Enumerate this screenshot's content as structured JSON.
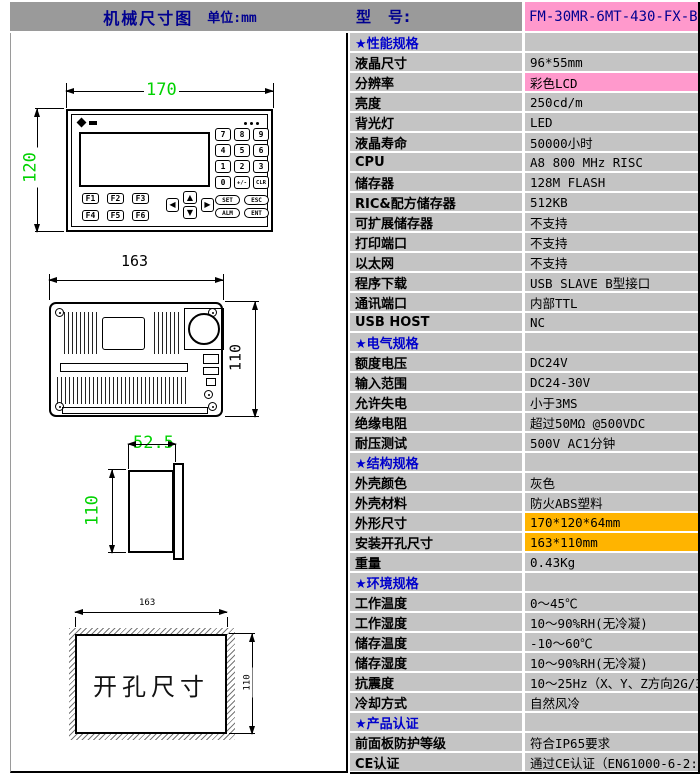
{
  "colors": {
    "header_gray": "#9a9a9a",
    "cell_gray": "#c4c4c4",
    "pink": "#ff99cc",
    "orange": "#ffb400",
    "navy": "#000090",
    "section_blue": "#0000cc",
    "dim_green": "#00d200"
  },
  "header": {
    "left_title": "机械尺寸图",
    "left_unit": "单位:mm",
    "model_label": "型　号:",
    "model_value": "FM-30MR-6MT-430-FX-B"
  },
  "drawings": {
    "front_view": {
      "width_dim": "170",
      "height_dim": "120",
      "numpad_keys": [
        "7",
        "8",
        "9",
        "4",
        "5",
        "6",
        "1",
        "2",
        "3",
        "0",
        "+/-",
        "CLR"
      ],
      "function_keys": [
        "F1",
        "F2",
        "F3",
        "F4",
        "F5",
        "F6"
      ],
      "control_keys": [
        "SET",
        "ESC",
        "ALM",
        "ENT"
      ],
      "arrow_keys": [
        "◀",
        "▲",
        "▼",
        "▶"
      ]
    },
    "back_view": {
      "width_dim": "163",
      "height_dim": "110"
    },
    "side_view": {
      "depth_dim": "52.5",
      "height_dim": "110"
    },
    "cutout_view": {
      "label": "开孔尺寸",
      "width_dim": "163",
      "height_dim": "110"
    }
  },
  "spec_table": {
    "rows": [
      {
        "type": "section",
        "label": "★性能规格",
        "value": ""
      },
      {
        "type": "data",
        "label": "液晶尺寸",
        "value": "96*55mm"
      },
      {
        "type": "data",
        "label": "分辨率",
        "value": "彩色LCD",
        "highlight": "pink"
      },
      {
        "type": "data",
        "label": "亮度",
        "value": "250cd/m"
      },
      {
        "type": "data",
        "label": "背光灯",
        "value": "LED"
      },
      {
        "type": "data",
        "label": "液晶寿命",
        "value": "50000小时"
      },
      {
        "type": "data",
        "label": "CPU",
        "value": "A8 800 MHz RISC"
      },
      {
        "type": "data",
        "label": "储存器",
        "value": "128M FLASH"
      },
      {
        "type": "data",
        "label": "RIC&配方储存器",
        "value": "512KB"
      },
      {
        "type": "data",
        "label": "可扩展储存器",
        "value": "不支持"
      },
      {
        "type": "data",
        "label": "打印端口",
        "value": "不支持"
      },
      {
        "type": "data",
        "label": "以太网",
        "value": "不支持"
      },
      {
        "type": "data",
        "label": "程序下载",
        "value": "USB SLAVE B型接口"
      },
      {
        "type": "data",
        "label": "通讯端口",
        "value": "内部TTL"
      },
      {
        "type": "data",
        "label": "USB HOST",
        "value": "NC"
      },
      {
        "type": "section",
        "label": "★电气规格",
        "value": ""
      },
      {
        "type": "data",
        "label": "额度电压",
        "value": "DC24V"
      },
      {
        "type": "data",
        "label": "输入范围",
        "value": "DC24-30V"
      },
      {
        "type": "data",
        "label": "允许失电",
        "value": "小于3MS"
      },
      {
        "type": "data",
        "label": "绝缘电阻",
        "value": "超过50MΩ @500VDC"
      },
      {
        "type": "data",
        "label": "耐压测试",
        "value": "500V AC1分钟"
      },
      {
        "type": "section",
        "label": "★结构规格",
        "value": ""
      },
      {
        "type": "data",
        "label": "外壳颜色",
        "value": "灰色"
      },
      {
        "type": "data",
        "label": "外壳材料",
        "value": "防火ABS塑料"
      },
      {
        "type": "data",
        "label": "外形尺寸",
        "value": "170*120*64mm",
        "highlight": "orange"
      },
      {
        "type": "data",
        "label": "安装开孔尺寸",
        "value": "163*110mm",
        "highlight": "orange"
      },
      {
        "type": "data",
        "label": "重量",
        "value": "0.43Kg"
      },
      {
        "type": "section",
        "label": "★环境规格",
        "value": ""
      },
      {
        "type": "data",
        "label": "工作温度",
        "value": "0～45℃"
      },
      {
        "type": "data",
        "label": "工作湿度",
        "value": "10～90%RH(无冷凝)"
      },
      {
        "type": "data",
        "label": "储存温度",
        "value": "-10～60℃"
      },
      {
        "type": "data",
        "label": "储存湿度",
        "value": "10～90%RH(无冷凝)"
      },
      {
        "type": "data",
        "label": "抗震度",
        "value": "10～25Hz（X、Y、Z方向2G/30分钟）"
      },
      {
        "type": "data",
        "label": "冷却方式",
        "value": "自然风冷"
      },
      {
        "type": "section",
        "label": "★产品认证",
        "value": ""
      },
      {
        "type": "data",
        "label": "前面板防护等级",
        "value": "符合IP65要求"
      },
      {
        "type": "data",
        "label": "CE认证",
        "value": "通过CE认证（EN61000-6-2:200S）"
      }
    ]
  }
}
